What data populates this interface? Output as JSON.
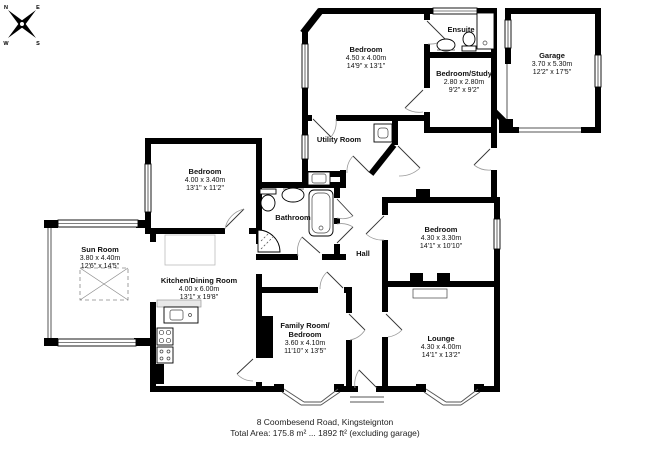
{
  "document": {
    "address": "8 Coombesend Road, Kingsteignton",
    "total_area": "Total Area: 175.8 m² ... 1892 ft² (excluding garage)"
  },
  "compass": {
    "north": "N",
    "east": "E",
    "south": "S",
    "west": "W"
  },
  "rooms": {
    "bedroom_top": {
      "name": "Bedroom",
      "metric": "4.50 x 4.00m",
      "imperial": "14'9\" x 13'1\""
    },
    "ensuite": {
      "name": "Ensuite"
    },
    "garage": {
      "name": "Garage",
      "metric": "3.70 x 5.30m",
      "imperial": "12'2\" x 17'5\""
    },
    "bedroom_study": {
      "name": "Bedroom/Study",
      "metric": "2.80 x 2.80m",
      "imperial": "9'2\" x 9'2\""
    },
    "utility": {
      "name": "Utility Room"
    },
    "bedroom_left": {
      "name": "Bedroom",
      "metric": "4.00 x 3.40m",
      "imperial": "13'1\" x 11'2\""
    },
    "bathroom": {
      "name": "Bathroom"
    },
    "hall": {
      "name": "Hall"
    },
    "bedroom_right": {
      "name": "Bedroom",
      "metric": "4.30 x 3.30m",
      "imperial": "14'1\" x 10'10\""
    },
    "sun_room": {
      "name": "Sun Room",
      "metric": "3.80 x 4.40m",
      "imperial": "12'6\" x 14'5\""
    },
    "kitchen": {
      "name": "Kitchen/Dining Room",
      "metric": "4.00 x 6.00m",
      "imperial": "13'1\" x 19'8\""
    },
    "family_room": {
      "name": "Family Room/",
      "name2": "Bedroom",
      "metric": "3.60 x 4.10m",
      "imperial": "11'10\" x 13'5\""
    },
    "lounge": {
      "name": "Lounge",
      "metric": "4.30 x 4.00m",
      "imperial": "14'1\" x 13'2\""
    }
  },
  "colors": {
    "wall": "#000000",
    "background": "#ffffff",
    "thin_line": "#555555"
  }
}
